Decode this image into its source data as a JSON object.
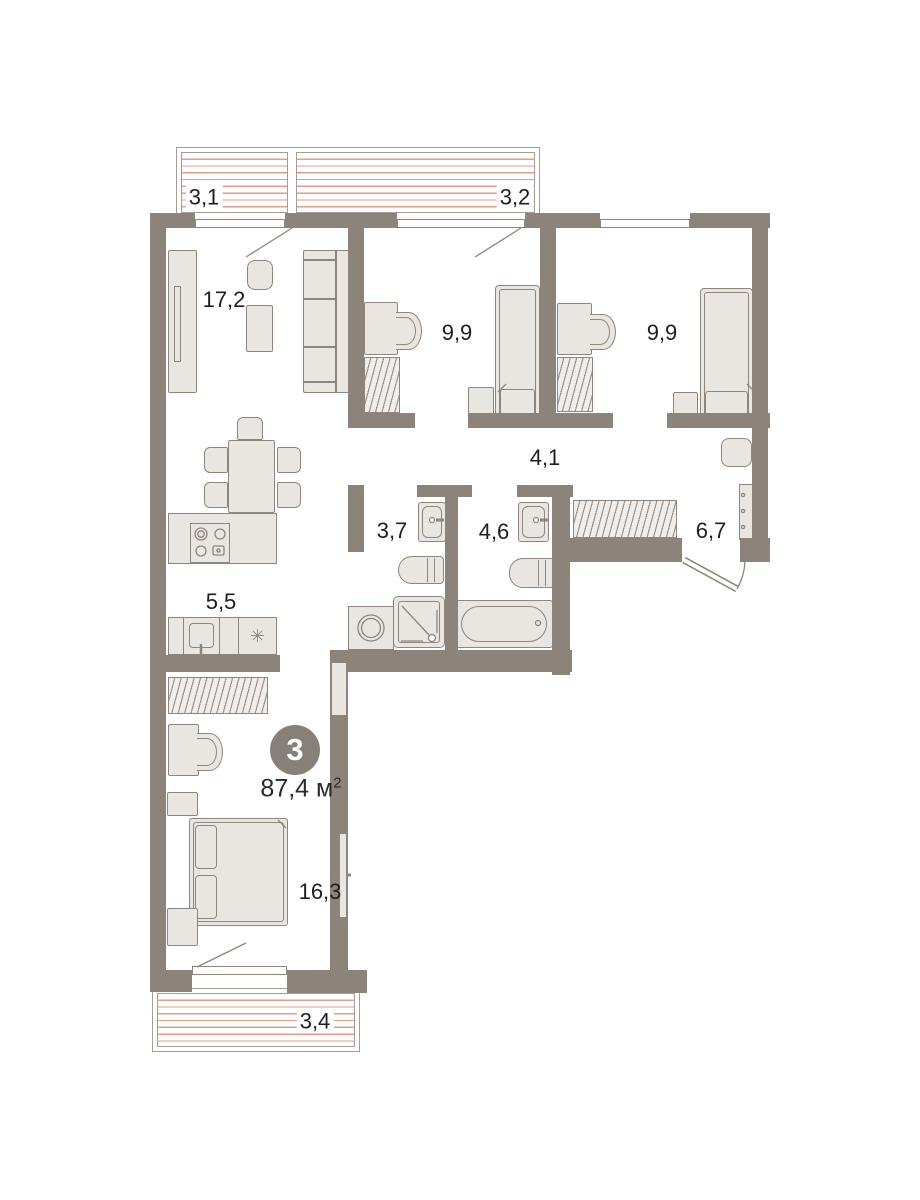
{
  "plan_type": "apartment-floor-plan",
  "badge": {
    "rooms_count": "3",
    "total_area": "87,4",
    "area_unit": " м",
    "area_sup": "2"
  },
  "rooms": {
    "balcony_top_left": {
      "name": "balcony",
      "area": "3,1"
    },
    "balcony_top_right": {
      "name": "balcony",
      "area": "3,2"
    },
    "living_room": {
      "name": "living-room",
      "area": "17,2"
    },
    "bedroom_top_left": {
      "name": "bedroom",
      "area": "9,9"
    },
    "bedroom_top_right": {
      "name": "bedroom",
      "area": "9,9"
    },
    "hallway": {
      "name": "hallway",
      "area": "4,1"
    },
    "bathroom_shower": {
      "name": "shower-room",
      "area": "3,7"
    },
    "bathroom_tub": {
      "name": "bathroom",
      "area": "4,6"
    },
    "entry_hall": {
      "name": "entry-hall",
      "area": "6,7"
    },
    "kitchen": {
      "name": "kitchen",
      "area": "5,5"
    },
    "bedroom_bottom": {
      "name": "master-bedroom",
      "area": "16,3"
    },
    "balcony_bottom": {
      "name": "balcony",
      "area": "3,4"
    }
  },
  "icons": {
    "fridge": "✳"
  },
  "colors": {
    "wall": "#8C847B",
    "furniture_fill": "#E9E5E1",
    "hatch_red": "#DF9C91"
  }
}
